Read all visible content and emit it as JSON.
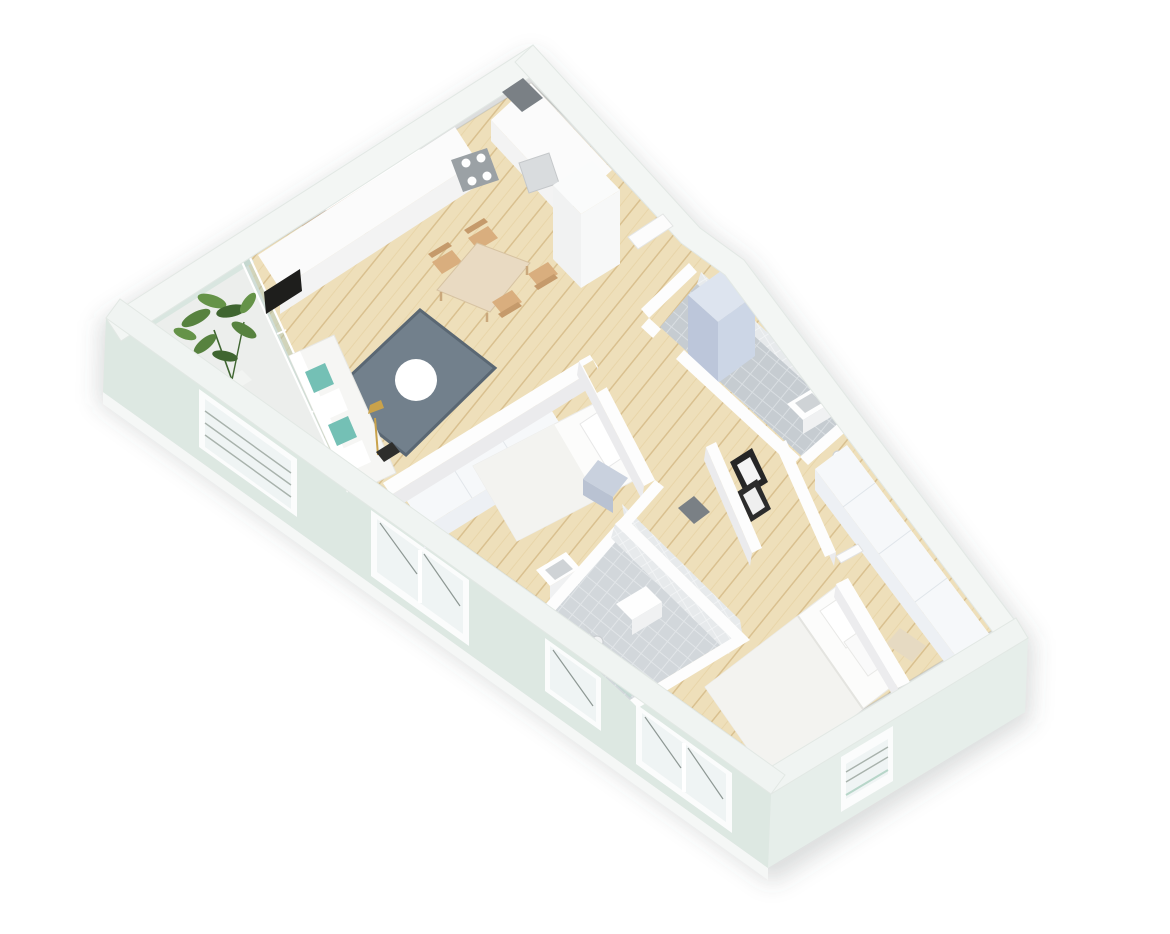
{
  "meta": {
    "title": "3D isometric apartment floor plan render",
    "style": "axonometric cutaway, walls cut at half height",
    "background": "#ffffff"
  },
  "colors": {
    "bg": "#ffffff",
    "shadow": "rgba(80,90,85,0.20)",
    "extWallTop": "#f3f6f4",
    "extWallEdge": "#e2e8e4",
    "swFront": "#dde8e2",
    "seFront": "#e6eeea",
    "baseStrip": "#f5f7f6",
    "intWallTop": "#fdfdfd",
    "intWallFace": "#ebebed",
    "wood": "#eedfba",
    "woodLine": "#d9c08f",
    "balconyFloor": "#eceeec",
    "glass": "#a9c6bb",
    "glassFrame": "#ffffff",
    "balustrade": "#d9e6e0",
    "tileFloor": "#c6ccd1",
    "tileLine": "#d9dee2",
    "tileWall": "#e7eaec",
    "tealStrip": "#b7d6c9",
    "niche": "#7a8085",
    "rug": "#72808c",
    "rugDark": "#5a6773",
    "coffeeTable": "#ffffff",
    "sofa": "#f6f6f4",
    "pillowTeal": "#74c0b5",
    "pillowWhite": "#ffffff",
    "lampGold": "#c9a24b",
    "potDark": "#2e2e2c",
    "tableWood": "#e9dac2",
    "chairWood": "#d9ae7e",
    "chairBack": "#c59a6b",
    "counterTop": "#fbfbfb",
    "counterFront": "#f3f3f3",
    "ovenBlack": "#1e1e1c",
    "stoveGray": "#9ba1a5",
    "burnerWhite": "#fefefe",
    "sinkInset": "#d9dcde",
    "slatWood": "#b98e63",
    "slatLine": "#9e7650",
    "cabinetWhite": "#fafbfb",
    "cabinetSide": "#f1f2f2",
    "mattress": "#fcfcfb",
    "blanket": "#f3f3f0",
    "pillow": "#ffffff",
    "headboard": "#e9e4d8",
    "nightstand": "#c9d1de",
    "nightstandFront": "#b9c2d2",
    "wardrobeTop": "#f6f8fa",
    "wardrobeFront": "#edf0f4",
    "washerTop": "#dde4ef",
    "washerFront": "#ccd6e6",
    "washerSide": "#bcc6da",
    "fixtureWhite": "#fefefe",
    "fixtureGray": "#cfd3d6",
    "benchTan": "#e6dac2",
    "framesBlack": "#262626",
    "framesWhite": "#f5f5f5",
    "doorLeaf": "#fcfcfc",
    "doorEdge": "#e2e2e2",
    "plantGreen": "#57823f",
    "plantDark": "#3f6530",
    "plantLight": "#659348",
    "sashLine": "#8e9894",
    "louverLine": "#a8b2ac",
    "windowGlass": "#eff4f4",
    "windowFrame": "#fbfcfc",
    "contactLine": "rgba(130,135,130,0.30)"
  },
  "rooms": [
    {
      "name": "living-room-kitchen",
      "floor": "wood"
    },
    {
      "name": "balcony",
      "floor": "concrete",
      "shape": "triangular"
    },
    {
      "name": "bedroom-small",
      "floor": "wood"
    },
    {
      "name": "bathroom-top",
      "floor": "tile"
    },
    {
      "name": "bathroom-bottom",
      "floor": "tile"
    },
    {
      "name": "bedroom-master",
      "floor": "wood"
    },
    {
      "name": "hallway",
      "floor": "wood"
    }
  ],
  "furniture": [
    "kitchen-counter-l-shape",
    "stove-cooktop",
    "kitchen-sink",
    "oven",
    "wood-slat-backsplash",
    "upper-cabinets",
    "tall-cabinet-fridge",
    "dining-table",
    "dining-chairs-x4",
    "sofa",
    "rug",
    "round-coffee-table",
    "floor-lamp",
    "plant",
    "dark-vase",
    "single-bed",
    "nightstand",
    "wardrobe-small-bedroom",
    "washing-machine",
    "bathroom-sink-x2",
    "shower-set",
    "toilet-brush",
    "double-bed",
    "pillows",
    "bench",
    "wardrobe-master",
    "headboard-partition",
    "picture-frames-shelf"
  ],
  "openings": {
    "windows_southwest_wall": 4,
    "windows_southeast_wall": 1,
    "entrance-door": 1,
    "glass-wall-balcony": 1
  }
}
